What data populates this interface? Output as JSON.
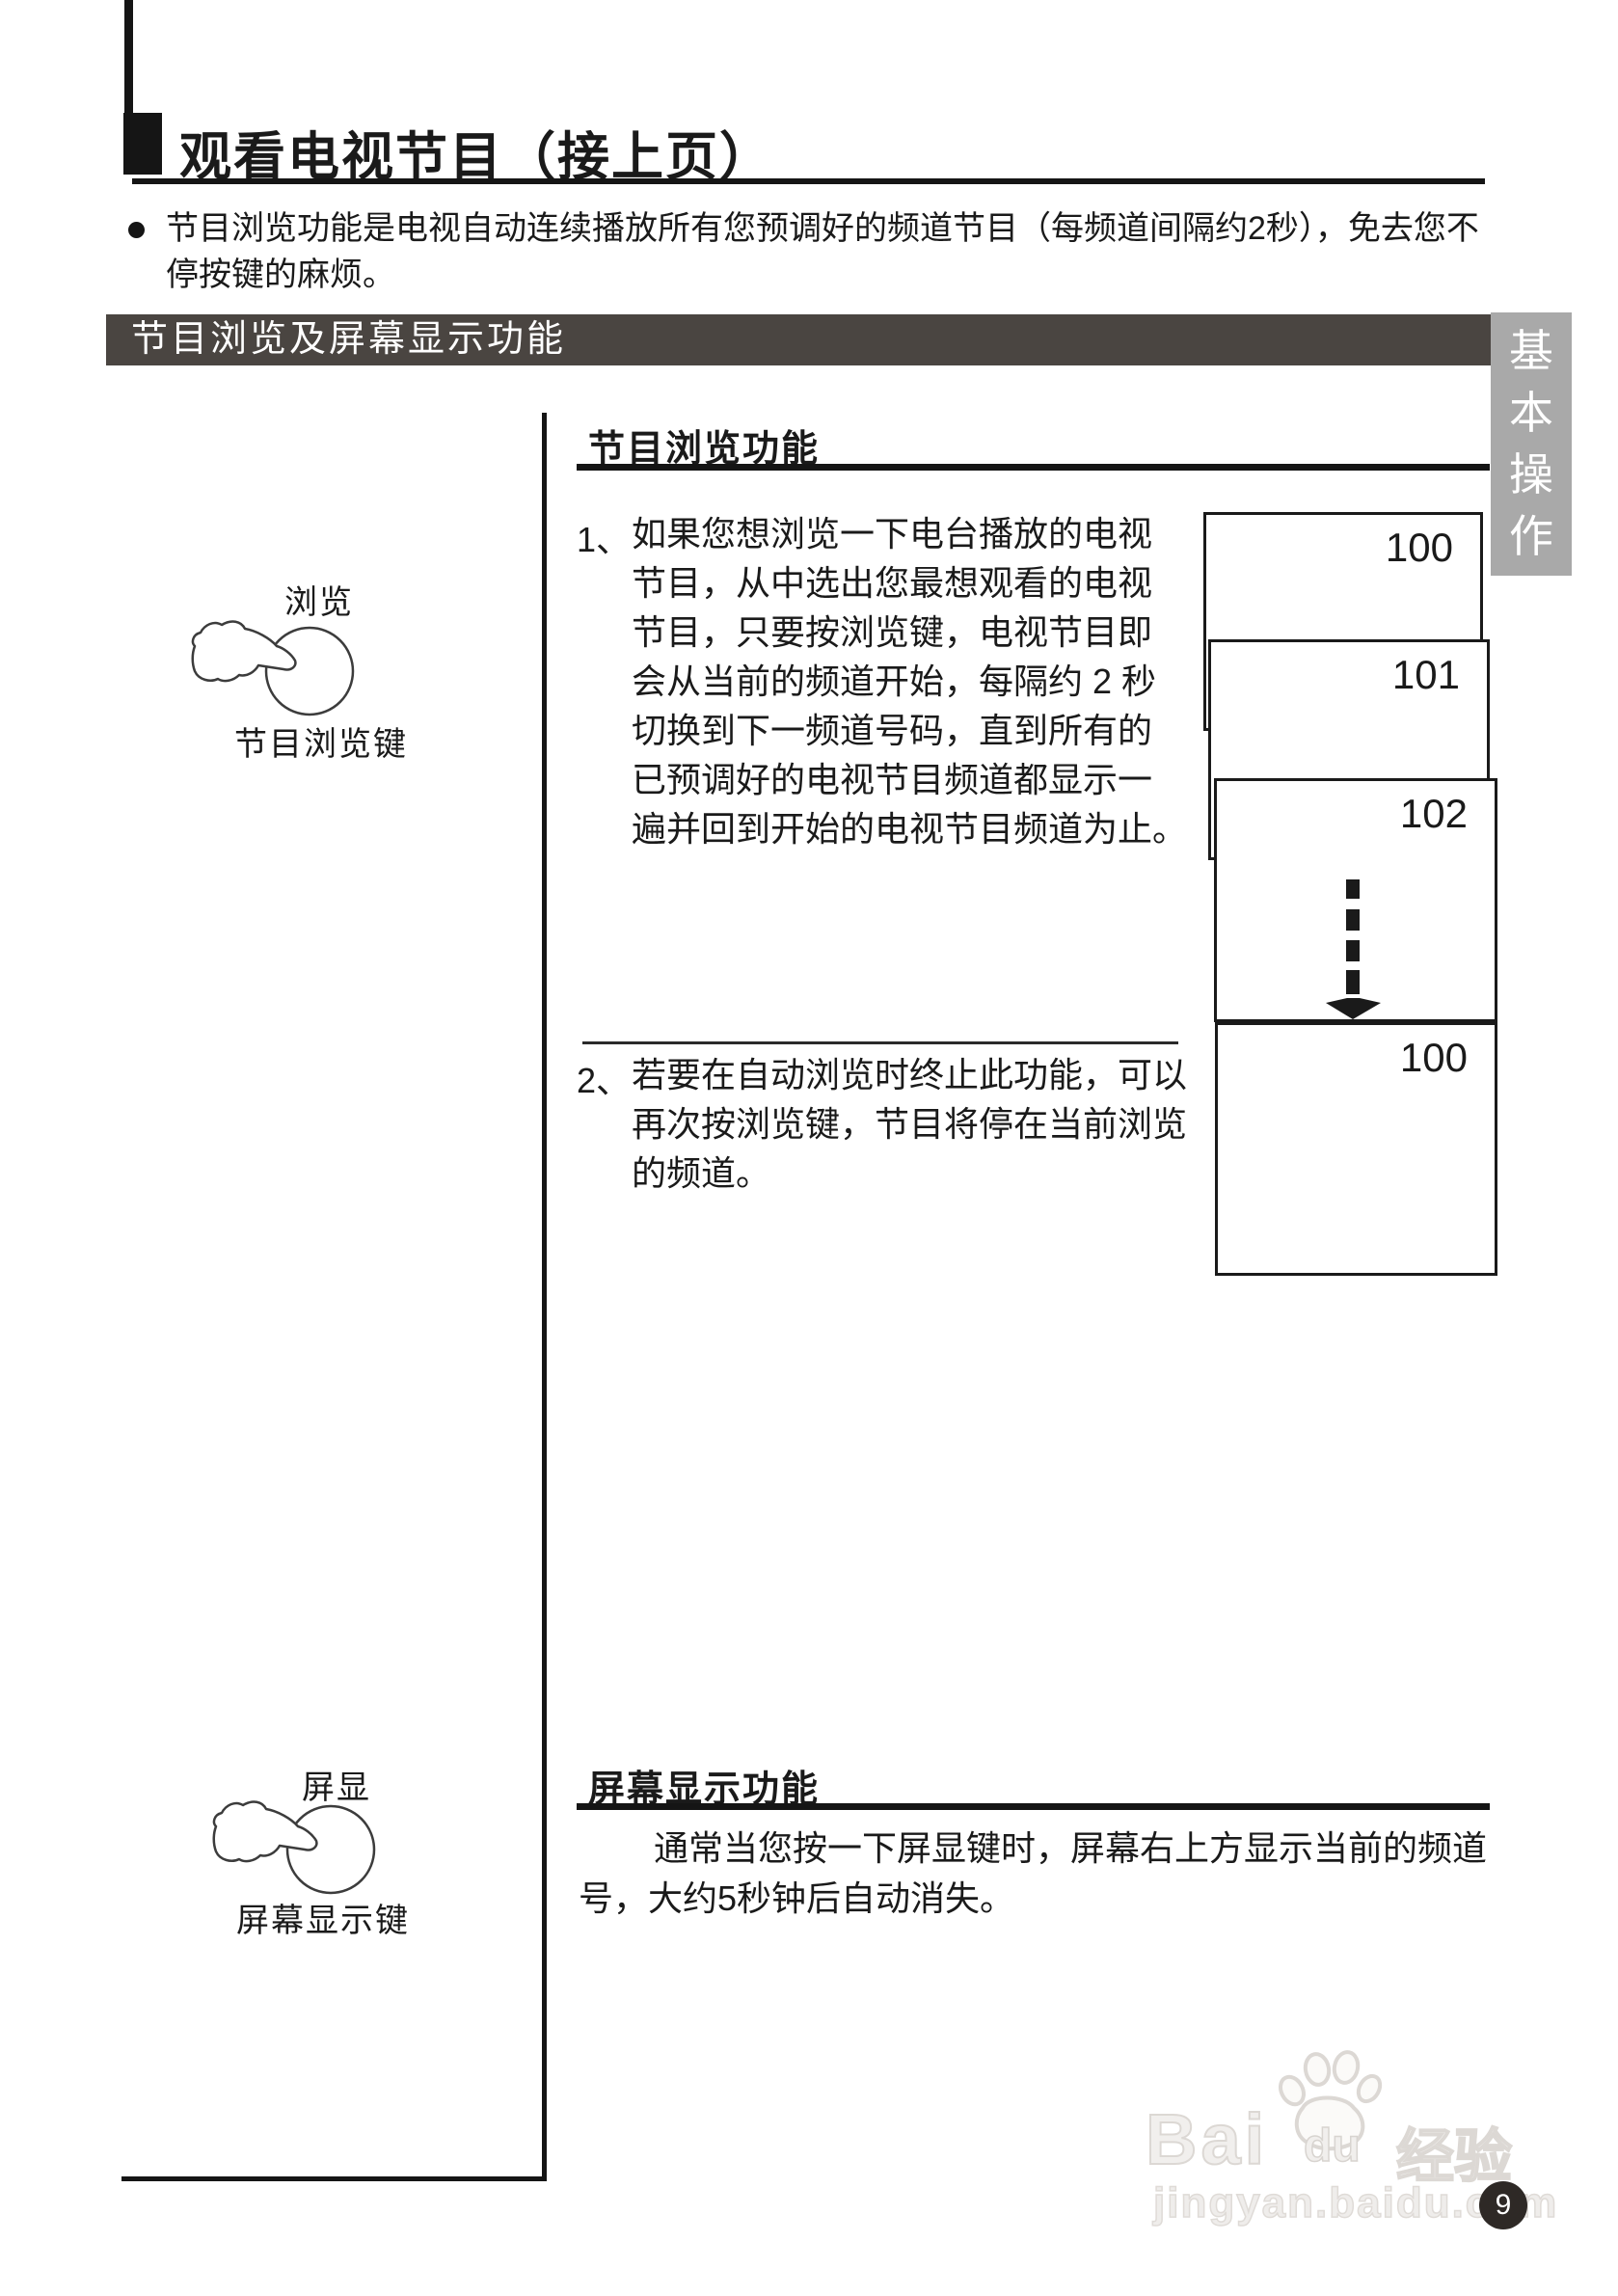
{
  "page": {
    "title": "观看电视节目（接上页）",
    "page_number": "9"
  },
  "intro": {
    "text": "节目浏览功能是电视自动连续播放所有您预调好的频道节目（每频道间隔约2秒），免去您不停按键的麻烦。"
  },
  "section_bar": {
    "label": "节目浏览及屏幕显示功能"
  },
  "side_tab": {
    "label": "基本操作"
  },
  "browse": {
    "heading": "节目浏览功能",
    "item1": {
      "number": "1、",
      "lines": [
        "如果您想浏览一下电台播放的电视",
        "节目，从中选出您最想观看的电视",
        "节目，只要按浏览键，电视节目即",
        "会从当前的频道开始，每隔约 2 秒",
        "切换到下一频道号码，直到所有的",
        "已预调好的电视节目频道都显示一",
        "遍并回到开始的电视节目频道为止。"
      ]
    },
    "item2": {
      "number": "2、",
      "lines": [
        "若要在自动浏览时终止此功能，可以",
        "再次按浏览键，节目将停在当前浏览",
        "的频道。"
      ]
    },
    "channel_boxes": [
      "100",
      "101",
      "102",
      "100"
    ]
  },
  "browse_key": {
    "label": "浏览",
    "caption": "节目浏览键"
  },
  "display_key": {
    "label": "屏显",
    "caption": "屏幕显示键"
  },
  "display": {
    "heading": "屏幕显示功能",
    "lines": [
      "通常当您按一下屏显键时，屏幕右上方显示当前的频道",
      "号，大约5秒钟后自动消失。"
    ]
  },
  "watermark": {
    "bai": "Bai",
    "du": "du",
    "cn": "经验",
    "url": "jingyan.baidu.com"
  }
}
